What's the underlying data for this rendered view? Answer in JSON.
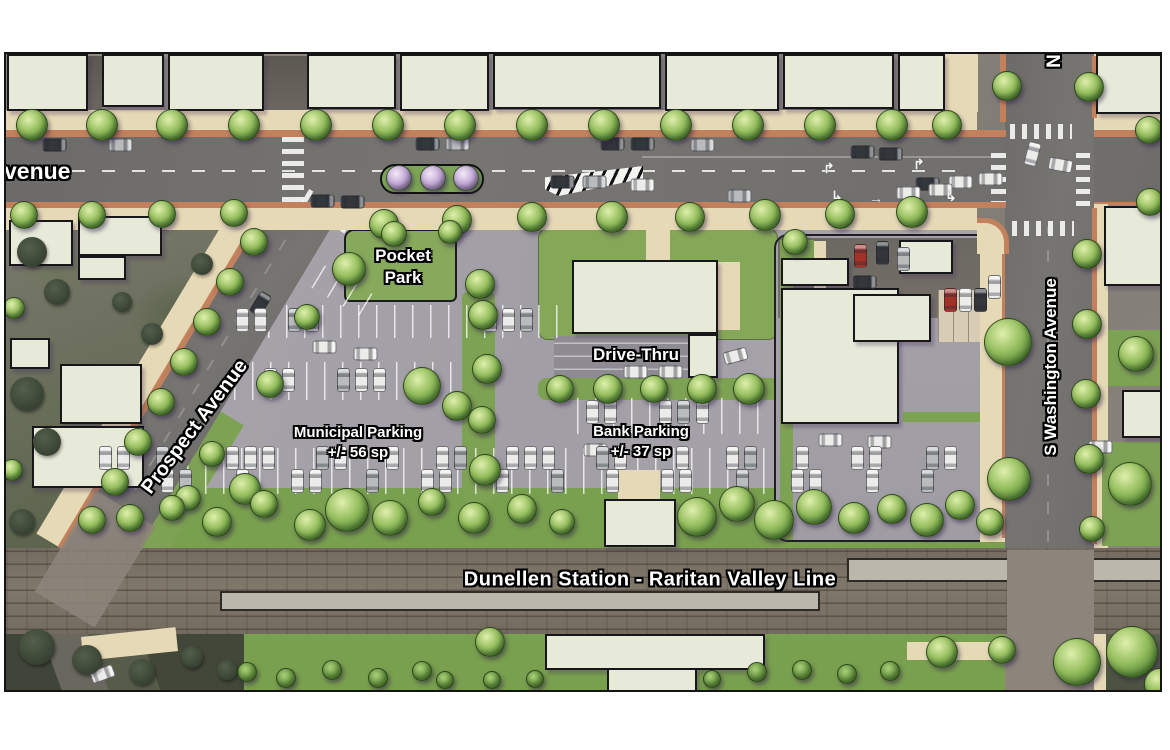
{
  "map": {
    "labels": {
      "avenue_partial": "venue",
      "prospect": "Prospect Avenue",
      "washington": "S Washington Avenue",
      "washington_north_partial": "N",
      "pocket_line1": "Pocket",
      "pocket_line2": "Park",
      "drive_thru": "Drive-Thru",
      "municipal_line1": "Municipal Parking",
      "municipal_line2": "+/- 56 sp",
      "bank_line1": "Bank Parking",
      "bank_line2": "+/- 37 sp",
      "station": "Dunellen Station - Raritan Valley Line"
    }
  },
  "palette": {
    "building": "#e7ead9",
    "sidewalk": "#e6d9b6",
    "curb": "#c2815c",
    "road": "#716f6d",
    "parking_lot": "#a7a3aa",
    "green": "#7ea253",
    "tree_green": "#6fa04a",
    "tree_purple": "#b497cf",
    "rail_bed": "#7a7165",
    "label_text": "#ffffff",
    "label_outline": "#000000",
    "car_white": "#ececea",
    "car_dark": "#33363b",
    "car_silver": "#b9bbbd",
    "car_red": "#a23128"
  },
  "features": {
    "buildings": [
      [
        5,
        52,
        81,
        57
      ],
      [
        100,
        52,
        62,
        53
      ],
      [
        166,
        52,
        96,
        57
      ],
      [
        305,
        52,
        89,
        55
      ],
      [
        398,
        52,
        89,
        57
      ],
      [
        491,
        52,
        168,
        55
      ],
      [
        663,
        52,
        114,
        57
      ],
      [
        781,
        52,
        111,
        55
      ],
      [
        896,
        52,
        47,
        57
      ],
      [
        1094,
        52,
        69,
        60
      ],
      [
        7,
        218,
        64,
        46
      ],
      [
        76,
        214,
        84,
        40
      ],
      [
        76,
        254,
        48,
        24
      ],
      [
        8,
        336,
        40,
        31
      ],
      [
        58,
        362,
        82,
        60
      ],
      [
        30,
        424,
        112,
        62
      ],
      [
        1102,
        204,
        61,
        80
      ],
      [
        1120,
        388,
        43,
        48
      ],
      [
        779,
        256,
        68,
        28
      ],
      [
        779,
        286,
        118,
        136
      ],
      [
        851,
        292,
        78,
        48
      ],
      [
        897,
        238,
        54,
        34
      ],
      [
        570,
        258,
        146,
        74
      ],
      [
        686,
        332,
        30,
        44
      ],
      [
        543,
        632,
        220,
        36
      ],
      [
        605,
        666,
        90,
        26
      ],
      [
        602,
        497,
        72,
        48
      ]
    ],
    "trees": [
      [
        30,
        123,
        16
      ],
      [
        100,
        123,
        16
      ],
      [
        170,
        123,
        16
      ],
      [
        242,
        123,
        16
      ],
      [
        314,
        123,
        16
      ],
      [
        386,
        123,
        16
      ],
      [
        458,
        123,
        16
      ],
      [
        530,
        123,
        16
      ],
      [
        602,
        123,
        16
      ],
      [
        674,
        123,
        16
      ],
      [
        746,
        123,
        16
      ],
      [
        818,
        123,
        16
      ],
      [
        890,
        123,
        16
      ],
      [
        945,
        123,
        15
      ],
      [
        1005,
        84,
        15
      ],
      [
        1087,
        85,
        15
      ],
      [
        1147,
        128,
        14
      ],
      [
        1148,
        200,
        14
      ],
      [
        22,
        213,
        14
      ],
      [
        90,
        213,
        14
      ],
      [
        160,
        212,
        14
      ],
      [
        232,
        211,
        14
      ],
      [
        382,
        222,
        15
      ],
      [
        455,
        218,
        15
      ],
      [
        530,
        215,
        15
      ],
      [
        610,
        215,
        16
      ],
      [
        688,
        215,
        15
      ],
      [
        763,
        213,
        16
      ],
      [
        838,
        212,
        15
      ],
      [
        910,
        210,
        16
      ],
      [
        252,
        240,
        14
      ],
      [
        228,
        280,
        14
      ],
      [
        205,
        320,
        14
      ],
      [
        182,
        360,
        14
      ],
      [
        159,
        400,
        14
      ],
      [
        136,
        440,
        14
      ],
      [
        113,
        480,
        14
      ],
      [
        90,
        518,
        14
      ],
      [
        210,
        452,
        13
      ],
      [
        186,
        496,
        13
      ],
      [
        243,
        487,
        16
      ],
      [
        1085,
        252,
        15
      ],
      [
        1085,
        322,
        15
      ],
      [
        1084,
        392,
        15
      ],
      [
        1087,
        457,
        15
      ],
      [
        1090,
        527,
        13
      ],
      [
        1006,
        340,
        24
      ],
      [
        1007,
        477,
        22
      ],
      [
        793,
        240,
        13
      ],
      [
        1134,
        352,
        18
      ],
      [
        1128,
        482,
        22
      ],
      [
        392,
        232,
        13
      ],
      [
        448,
        230,
        12
      ],
      [
        347,
        267,
        17
      ],
      [
        478,
        282,
        15
      ],
      [
        305,
        315,
        13
      ],
      [
        268,
        382,
        14
      ],
      [
        420,
        384,
        19
      ],
      [
        455,
        404,
        15
      ],
      [
        481,
        313,
        15
      ],
      [
        485,
        367,
        15
      ],
      [
        480,
        418,
        14
      ],
      [
        483,
        468,
        16
      ],
      [
        558,
        387,
        14
      ],
      [
        606,
        387,
        15
      ],
      [
        652,
        387,
        14
      ],
      [
        700,
        387,
        15
      ],
      [
        747,
        387,
        16
      ],
      [
        128,
        516,
        14
      ],
      [
        170,
        506,
        13
      ],
      [
        215,
        520,
        15
      ],
      [
        262,
        502,
        14
      ],
      [
        308,
        523,
        16
      ],
      [
        345,
        508,
        22
      ],
      [
        388,
        516,
        18
      ],
      [
        430,
        500,
        14
      ],
      [
        472,
        516,
        16
      ],
      [
        520,
        507,
        15
      ],
      [
        560,
        520,
        13
      ],
      [
        695,
        515,
        20
      ],
      [
        735,
        502,
        18
      ],
      [
        772,
        518,
        20
      ],
      [
        812,
        505,
        18
      ],
      [
        852,
        516,
        16
      ],
      [
        890,
        507,
        15
      ],
      [
        925,
        518,
        17
      ],
      [
        958,
        503,
        15
      ],
      [
        988,
        520,
        14
      ],
      [
        488,
        640,
        15
      ],
      [
        940,
        650,
        16
      ],
      [
        1000,
        648,
        14
      ],
      [
        1075,
        660,
        24
      ],
      [
        1130,
        650,
        26
      ],
      [
        1158,
        682,
        16
      ],
      [
        12,
        306,
        11
      ],
      [
        10,
        468,
        11
      ]
    ],
    "purple_trees": [
      [
        397,
        176,
        13
      ],
      [
        431,
        176,
        13
      ],
      [
        464,
        176,
        13
      ]
    ],
    "bushes": [
      [
        245,
        670,
        10
      ],
      [
        284,
        676,
        10
      ],
      [
        330,
        668,
        10
      ],
      [
        376,
        676,
        10
      ],
      [
        420,
        669,
        10
      ],
      [
        443,
        678,
        9
      ],
      [
        490,
        678,
        9
      ],
      [
        533,
        677,
        9
      ],
      [
        710,
        677,
        9
      ],
      [
        755,
        670,
        10
      ],
      [
        800,
        668,
        10
      ],
      [
        845,
        672,
        10
      ],
      [
        888,
        669,
        10
      ]
    ],
    "dark_trees": [
      [
        30,
        250,
        15
      ],
      [
        55,
        290,
        13
      ],
      [
        25,
        392,
        17
      ],
      [
        45,
        440,
        14
      ],
      [
        120,
        300,
        10
      ],
      [
        150,
        332,
        11
      ],
      [
        20,
        520,
        13
      ],
      [
        200,
        262,
        11
      ],
      [
        35,
        645,
        18
      ],
      [
        85,
        658,
        15
      ],
      [
        140,
        670,
        13
      ],
      [
        190,
        655,
        11
      ],
      [
        225,
        668,
        10
      ]
    ],
    "cars": [
      [
        52,
        143,
        90,
        "d"
      ],
      [
        118,
        143,
        90,
        "s"
      ],
      [
        425,
        142,
        90,
        "d"
      ],
      [
        455,
        142,
        90,
        "s"
      ],
      [
        610,
        142,
        90,
        "d"
      ],
      [
        640,
        142,
        90,
        "d"
      ],
      [
        700,
        143,
        90,
        "s"
      ],
      [
        860,
        150,
        90,
        "d"
      ],
      [
        888,
        152,
        90,
        "d"
      ],
      [
        560,
        180,
        90,
        "d"
      ],
      [
        592,
        180,
        90,
        "s"
      ],
      [
        640,
        183,
        90,
        "w"
      ],
      [
        925,
        182,
        90,
        "d"
      ],
      [
        958,
        180,
        90,
        "w"
      ],
      [
        988,
        177,
        90,
        "w"
      ],
      [
        320,
        199,
        90,
        "d"
      ],
      [
        350,
        200,
        90,
        "d"
      ],
      [
        737,
        194,
        90,
        "s"
      ],
      [
        906,
        191,
        90,
        "w"
      ],
      [
        938,
        188,
        90,
        "w"
      ],
      [
        1030,
        152,
        15,
        "w"
      ],
      [
        1058,
        163,
        100,
        "w"
      ],
      [
        1098,
        445,
        90,
        "w"
      ],
      [
        858,
        254,
        0,
        "r"
      ],
      [
        880,
        251,
        0,
        "d"
      ],
      [
        901,
        257,
        0,
        "s"
      ],
      [
        862,
        280,
        90,
        "d"
      ],
      [
        948,
        298,
        0,
        "r"
      ],
      [
        963,
        298,
        0,
        "w"
      ],
      [
        978,
        298,
        0,
        "d"
      ],
      [
        992,
        285,
        0,
        "w"
      ],
      [
        633,
        370,
        90,
        "w"
      ],
      [
        668,
        370,
        90,
        "w"
      ],
      [
        733,
        354,
        75,
        "w"
      ],
      [
        590,
        410,
        0,
        "w"
      ],
      [
        608,
        410,
        0,
        "w"
      ],
      [
        663,
        410,
        0,
        "w"
      ],
      [
        681,
        410,
        0,
        "s"
      ],
      [
        700,
        410,
        0,
        "w"
      ],
      [
        593,
        448,
        90,
        "w"
      ],
      [
        322,
        345,
        90,
        "w"
      ],
      [
        363,
        352,
        90,
        "w"
      ],
      [
        828,
        438,
        90,
        "w"
      ],
      [
        877,
        440,
        90,
        "w"
      ],
      [
        100,
        672,
        70,
        "w"
      ],
      [
        258,
        302,
        31,
        "d"
      ]
    ],
    "car_rows": [
      {
        "y": 318,
        "rot": 0,
        "xs": [
          240,
          258,
          292,
          310,
          488,
          506,
          524
        ]
      },
      {
        "y": 378,
        "rot": 0,
        "xs": [
          268,
          286,
          341,
          359,
          377,
          420
        ]
      },
      {
        "y": 456,
        "rot": 0,
        "xs": [
          103,
          121,
          160,
          230,
          248,
          266,
          320,
          338,
          390,
          440,
          458,
          510,
          528,
          546,
          600,
          618,
          680,
          730,
          748,
          800,
          855,
          873,
          930,
          948
        ]
      },
      {
        "y": 479,
        "rot": 0,
        "xs": [
          110,
          165,
          183,
          240,
          295,
          313,
          370,
          425,
          443,
          500,
          555,
          610,
          665,
          683,
          740,
          795,
          813,
          870,
          925
        ]
      }
    ],
    "stall_rows": [
      [
        230,
        303,
        330,
        33,
        0
      ],
      [
        160,
        360,
        300,
        38,
        0
      ],
      [
        575,
        396,
        185,
        36,
        0
      ],
      [
        95,
        446,
        880,
        23,
        0
      ],
      [
        95,
        469,
        880,
        23,
        0
      ],
      [
        262,
        262,
        110,
        26,
        31
      ]
    ],
    "arrows": [
      [
        828,
        166,
        "↱"
      ],
      [
        836,
        194,
        "↳"
      ],
      [
        874,
        196,
        "→"
      ],
      [
        918,
        162,
        "↱"
      ],
      [
        950,
        194,
        "↳"
      ]
    ]
  }
}
